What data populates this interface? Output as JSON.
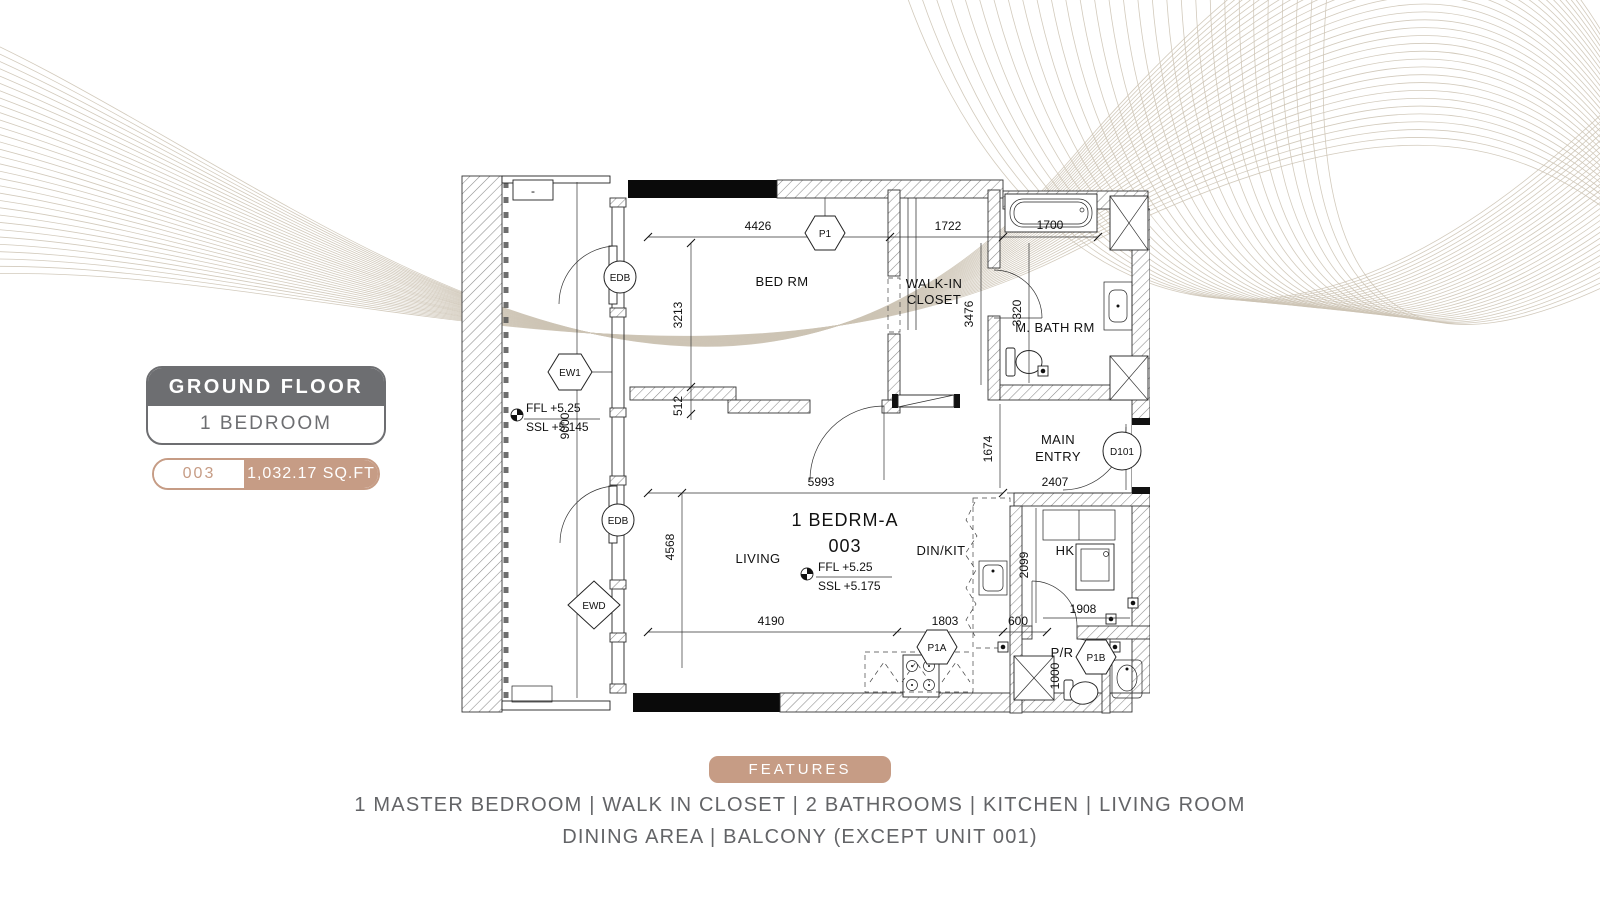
{
  "panel": {
    "floor": "GROUND FLOOR",
    "type": "1 BEDROOM",
    "unit": "003",
    "area": "1,032.17 SQ.FT"
  },
  "features": {
    "title": "FEATURES",
    "line1": "1 MASTER BEDROOM | WALK IN CLOSET | 2 BATHROOMS | KITCHEN | LIVING ROOM",
    "line2": "DINING AREA | BALCONY (EXCEPT UNIT 001)"
  },
  "plan": {
    "unit_title": "1 BEDRM-A",
    "unit_number": "003",
    "rooms": {
      "bedroom": "BED RM",
      "walkin1": "WALK-IN",
      "walkin2": "CLOSET",
      "mbath": "M. BATH RM",
      "entry1": "MAIN",
      "entry2": "ENTRY",
      "living": "LIVING",
      "dinkit": "DIN/KIT",
      "hk": "HK",
      "pr": "P/R"
    },
    "levels": {
      "living_ffl": "FFL +5.25",
      "living_ssl": "SSL +5.175",
      "balcony_ffl": "FFL +5.25",
      "balcony_ssl": "SSL +5.145"
    },
    "dims": {
      "bed_w": "4426",
      "closet_w": "1722",
      "tub_w": "1700",
      "bed_h": "3213",
      "closet_h": "3476",
      "bath_h": "3320",
      "step": "512",
      "balcony_h": "9000",
      "living_h": "4568",
      "living_w": "5993",
      "living_bw": "4190",
      "kit_bw": "1803",
      "kit_d": "600",
      "entry_h": "1674",
      "entry_w": "2407",
      "hk_h": "2099",
      "hk_w": "1908",
      "pr_h": "1000"
    },
    "tags": {
      "edb": "EDB",
      "ew1": "EW1",
      "ewd": "EWD",
      "p1": "P1",
      "p1a": "P1A",
      "p1b": "P1B",
      "d101": "D101"
    },
    "misc": {
      "panel_box": "-"
    }
  }
}
